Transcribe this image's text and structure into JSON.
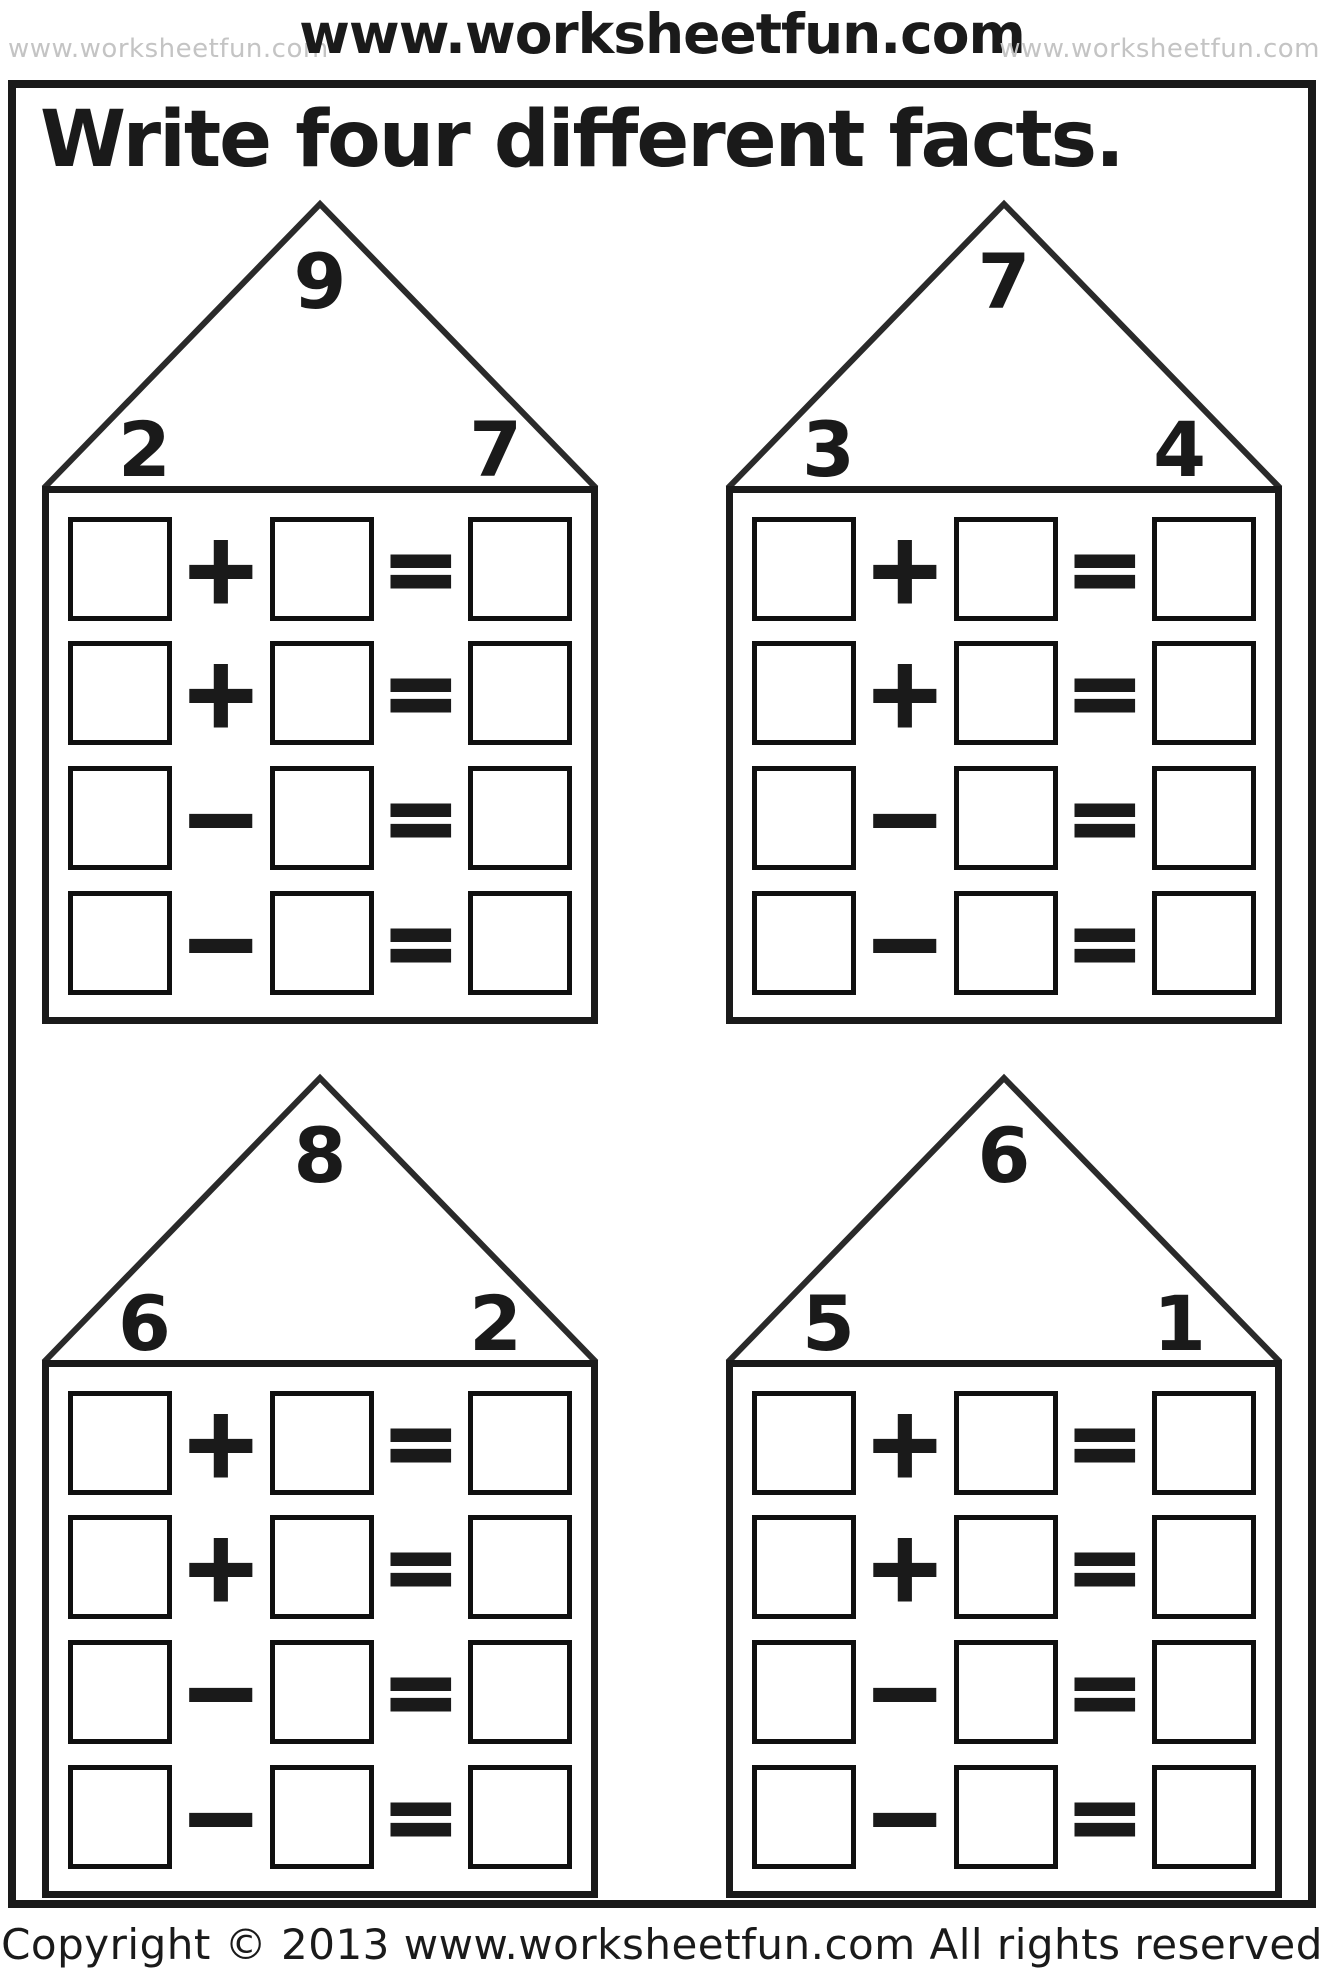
{
  "header": {
    "watermark_left": "www.worksheetfun.com",
    "site_title": "www.worksheetfun.com",
    "watermark_right": "www.worksheetfun.com"
  },
  "title": "Write four different facts.",
  "houses": [
    {
      "roof": {
        "top": "9",
        "left": "2",
        "right": "7"
      },
      "rows": [
        {
          "operator": "+",
          "equals": "="
        },
        {
          "operator": "+",
          "equals": "="
        },
        {
          "operator": "−",
          "equals": "="
        },
        {
          "operator": "−",
          "equals": "="
        }
      ]
    },
    {
      "roof": {
        "top": "7",
        "left": "3",
        "right": "4"
      },
      "rows": [
        {
          "operator": "+",
          "equals": "="
        },
        {
          "operator": "+",
          "equals": "="
        },
        {
          "operator": "−",
          "equals": "="
        },
        {
          "operator": "−",
          "equals": "="
        }
      ]
    },
    {
      "roof": {
        "top": "8",
        "left": "6",
        "right": "2"
      },
      "rows": [
        {
          "operator": "+",
          "equals": "="
        },
        {
          "operator": "+",
          "equals": "="
        },
        {
          "operator": "−",
          "equals": "="
        },
        {
          "operator": "−",
          "equals": "="
        }
      ]
    },
    {
      "roof": {
        "top": "6",
        "left": "5",
        "right": "1"
      },
      "rows": [
        {
          "operator": "+",
          "equals": "="
        },
        {
          "operator": "+",
          "equals": "="
        },
        {
          "operator": "−",
          "equals": "="
        },
        {
          "operator": "−",
          "equals": "="
        }
      ]
    }
  ],
  "footer": "Copyright © 2013 www.worksheetfun.com All rights reserved",
  "colors": {
    "ink": "#1a1a1a",
    "watermark_gray": "#c4c4c4",
    "paper": "#ffffff"
  }
}
